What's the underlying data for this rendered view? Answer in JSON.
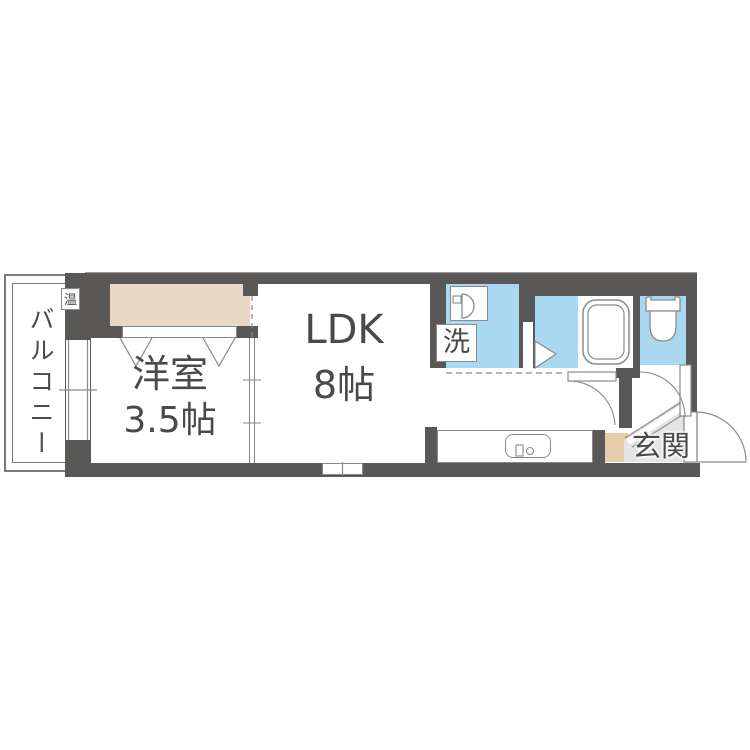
{
  "floorplan": {
    "balcony": {
      "label": "バルコニー"
    },
    "water_heater_badge": {
      "label": "温"
    },
    "western_room": {
      "name": "洋室",
      "size": "3.5帖"
    },
    "ldk": {
      "name": "LDK",
      "size": "8帖"
    },
    "entrance": {
      "label": "玄関"
    },
    "laundry": {
      "label": "洗"
    },
    "colors": {
      "wall": "#5a5757",
      "water_blue": "#a9d9f1",
      "closet_beige": "#ead8c4",
      "shoebox_beige": "#e5cdaa",
      "genkan_gray": "#e4e4e4",
      "line_gray": "#8a8a8a",
      "text": "#4a4848"
    }
  }
}
